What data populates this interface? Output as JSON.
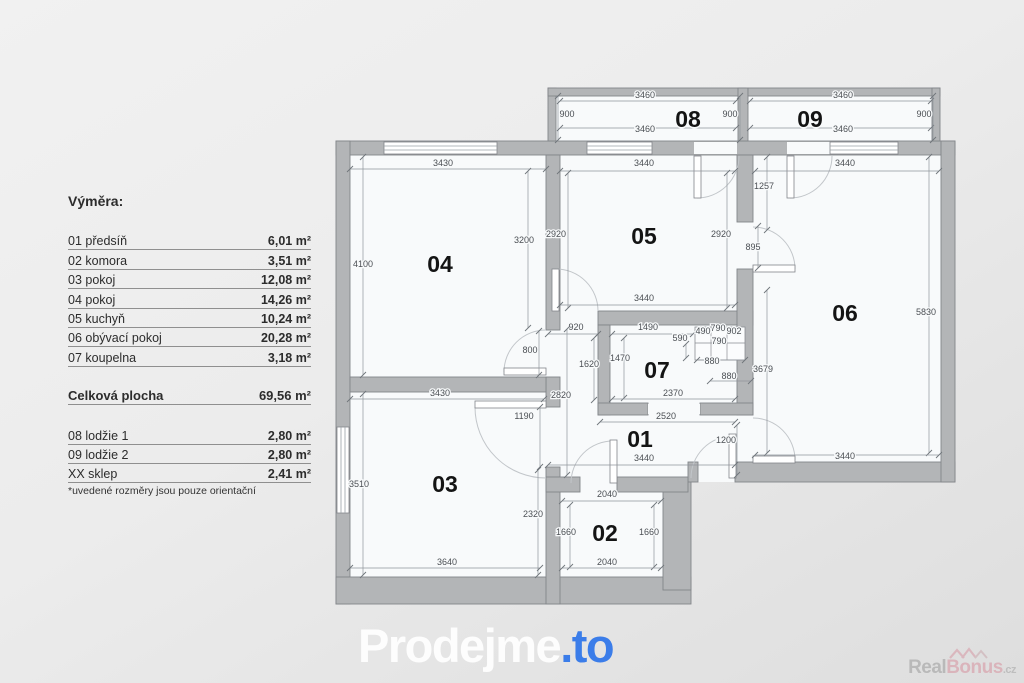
{
  "legend": {
    "title": "Výměra:",
    "rows": [
      {
        "label": "01 předsíň",
        "value": "6,01 m²"
      },
      {
        "label": "02 komora",
        "value": "3,51 m²"
      },
      {
        "label": "03 pokoj",
        "value": "12,08 m²"
      },
      {
        "label": "04 pokoj",
        "value": "14,26 m²"
      },
      {
        "label": "05 kuchyň",
        "value": "10,24 m²"
      },
      {
        "label": "06 obývací pokoj",
        "value": "20,28 m²"
      },
      {
        "label": "07 koupelna",
        "value": "3,18 m²"
      }
    ],
    "total": {
      "label": "Celková plocha",
      "value": "69,56 m²"
    },
    "extra_rows": [
      {
        "label": "08 lodžie 1",
        "value": "2,80 m²"
      },
      {
        "label": "09 lodžie 2",
        "value": "2,80 m²"
      },
      {
        "label": "XX sklep",
        "value": "2,41 m²"
      }
    ],
    "note": "*uvedené rozměry jsou pouze orientační"
  },
  "branding": {
    "logo_main": "Prodejme",
    "logo_suffix": ".to",
    "logo_accent_color": "#3b7de9",
    "watermark_part1": "Real",
    "watermark_part2": "Bonus",
    "watermark_suffix": ".cz"
  },
  "colors": {
    "wall": "#b3b5b7",
    "room_fill": "#f8fafb",
    "dim_text": "#4b4f54",
    "background": "#ececec"
  },
  "floorplan": {
    "rooms": [
      {
        "id": "01",
        "x": 640,
        "y": 447
      },
      {
        "id": "02",
        "x": 605,
        "y": 541
      },
      {
        "id": "03",
        "x": 445,
        "y": 492
      },
      {
        "id": "04",
        "x": 440,
        "y": 272
      },
      {
        "id": "05",
        "x": 644,
        "y": 244
      },
      {
        "id": "06",
        "x": 845,
        "y": 321
      },
      {
        "id": "07",
        "x": 657,
        "y": 378
      },
      {
        "id": "08",
        "x": 688,
        "y": 127
      },
      {
        "id": "09",
        "x": 810,
        "y": 127
      }
    ],
    "dimensions": [
      {
        "t": "900",
        "x": 567,
        "y": 117,
        "line": [
          558,
          96,
          558,
          140
        ]
      },
      {
        "t": "3460",
        "x": 645,
        "y": 98,
        "line": [
          560,
          101,
          736,
          101
        ]
      },
      {
        "t": "3460",
        "x": 645,
        "y": 132,
        "line": [
          560,
          128,
          736,
          128
        ]
      },
      {
        "t": "900",
        "x": 730,
        "y": 117,
        "line": [
          740,
          96,
          740,
          140
        ]
      },
      {
        "t": "3460",
        "x": 843,
        "y": 98,
        "line": [
          750,
          101,
          931,
          101
        ]
      },
      {
        "t": "3460",
        "x": 843,
        "y": 132,
        "line": [
          750,
          128,
          931,
          128
        ]
      },
      {
        "t": "900",
        "x": 924,
        "y": 117,
        "line": [
          933,
          96,
          933,
          140
        ]
      },
      {
        "t": "3430",
        "x": 443,
        "y": 166,
        "line": [
          350,
          169,
          546,
          169
        ]
      },
      {
        "t": "4100",
        "x": 363,
        "y": 267,
        "line": [
          363,
          157,
          363,
          375
        ]
      },
      {
        "t": "3200",
        "x": 524,
        "y": 243,
        "line": [
          528,
          171,
          528,
          328
        ]
      },
      {
        "t": "800",
        "x": 530,
        "y": 353,
        "line": [
          539,
          331,
          539,
          375
        ]
      },
      {
        "t": "3440",
        "x": 644,
        "y": 166,
        "line": [
          560,
          171,
          735,
          171
        ]
      },
      {
        "t": "2920",
        "x": 556,
        "y": 237,
        "line": [
          568,
          173,
          568,
          308
        ]
      },
      {
        "t": "2920",
        "x": 721,
        "y": 237,
        "line": [
          727,
          173,
          727,
          308
        ]
      },
      {
        "t": "3440",
        "x": 644,
        "y": 301,
        "line": [
          560,
          305,
          735,
          305
        ]
      },
      {
        "t": "3440",
        "x": 845,
        "y": 166,
        "line": [
          755,
          171,
          939,
          171
        ]
      },
      {
        "t": "1257",
        "x": 764,
        "y": 189,
        "line": [
          767,
          157,
          767,
          230
        ]
      },
      {
        "t": "895",
        "x": 753,
        "y": 250,
        "line": [
          758,
          226,
          758,
          268
        ]
      },
      {
        "t": "3679",
        "x": 763,
        "y": 372,
        "line": [
          767,
          290,
          767,
          453
        ]
      },
      {
        "t": "5830",
        "x": 926,
        "y": 315,
        "line": [
          929,
          157,
          929,
          453
        ]
      },
      {
        "t": "3440",
        "x": 845,
        "y": 459,
        "line": [
          755,
          455,
          939,
          455
        ]
      },
      {
        "t": "920",
        "x": 576,
        "y": 330,
        "line": [
          548,
          334,
          598,
          334
        ]
      },
      {
        "t": "1490",
        "x": 648,
        "y": 330,
        "line": [
          612,
          334,
          693,
          334
        ]
      },
      {
        "t": "590",
        "x": 680,
        "y": 341,
        "line": [
          686,
          344,
          686,
          358
        ]
      },
      {
        "t": "490",
        "x": 703,
        "y": 334
      },
      {
        "t": "790",
        "x": 718,
        "y": 331
      },
      {
        "t": "902",
        "x": 734,
        "y": 334
      },
      {
        "t": "790",
        "x": 719,
        "y": 344
      },
      {
        "t": "1620",
        "x": 589,
        "y": 367,
        "line": [
          594,
          338,
          594,
          400
        ]
      },
      {
        "t": "1470",
        "x": 620,
        "y": 361,
        "line": [
          624,
          338,
          624,
          398
        ]
      },
      {
        "t": "880",
        "x": 712,
        "y": 364,
        "line": [
          697,
          360,
          745,
          360
        ]
      },
      {
        "t": "880",
        "x": 729,
        "y": 379,
        "line": [
          710,
          381,
          751,
          381
        ]
      },
      {
        "t": "2370",
        "x": 673,
        "y": 396,
        "line": [
          612,
          399,
          735,
          399
        ]
      },
      {
        "t": "2820",
        "x": 561,
        "y": 398,
        "line": [
          567,
          329,
          567,
          475
        ]
      },
      {
        "t": "2520",
        "x": 666,
        "y": 419,
        "line": [
          600,
          422,
          735,
          422
        ]
      },
      {
        "t": "1200",
        "x": 726,
        "y": 443,
        "line": [
          737,
          425,
          737,
          475
        ]
      },
      {
        "t": "3440",
        "x": 644,
        "y": 461,
        "line": [
          548,
          465,
          735,
          465
        ]
      },
      {
        "t": "3430",
        "x": 440,
        "y": 396,
        "line": [
          350,
          399,
          544,
          399
        ]
      },
      {
        "t": "1190",
        "x": 524,
        "y": 419,
        "line": [
          540,
          407,
          540,
          467
        ]
      },
      {
        "t": "3510",
        "x": 359,
        "y": 487,
        "line": [
          363,
          394,
          363,
          575
        ]
      },
      {
        "t": "2320",
        "x": 533,
        "y": 517,
        "line": [
          538,
          470,
          538,
          575
        ]
      },
      {
        "t": "3640",
        "x": 447,
        "y": 565,
        "line": [
          350,
          568,
          540,
          568
        ]
      },
      {
        "t": "2040",
        "x": 607,
        "y": 497,
        "line": [
          562,
          501,
          661,
          501
        ]
      },
      {
        "t": "1660",
        "x": 566,
        "y": 535,
        "line": [
          570,
          505,
          570,
          567
        ]
      },
      {
        "t": "1660",
        "x": 649,
        "y": 535,
        "line": [
          654,
          505,
          654,
          567
        ]
      },
      {
        "t": "2040",
        "x": 607,
        "y": 565,
        "line": [
          562,
          568,
          661,
          568
        ]
      }
    ]
  }
}
